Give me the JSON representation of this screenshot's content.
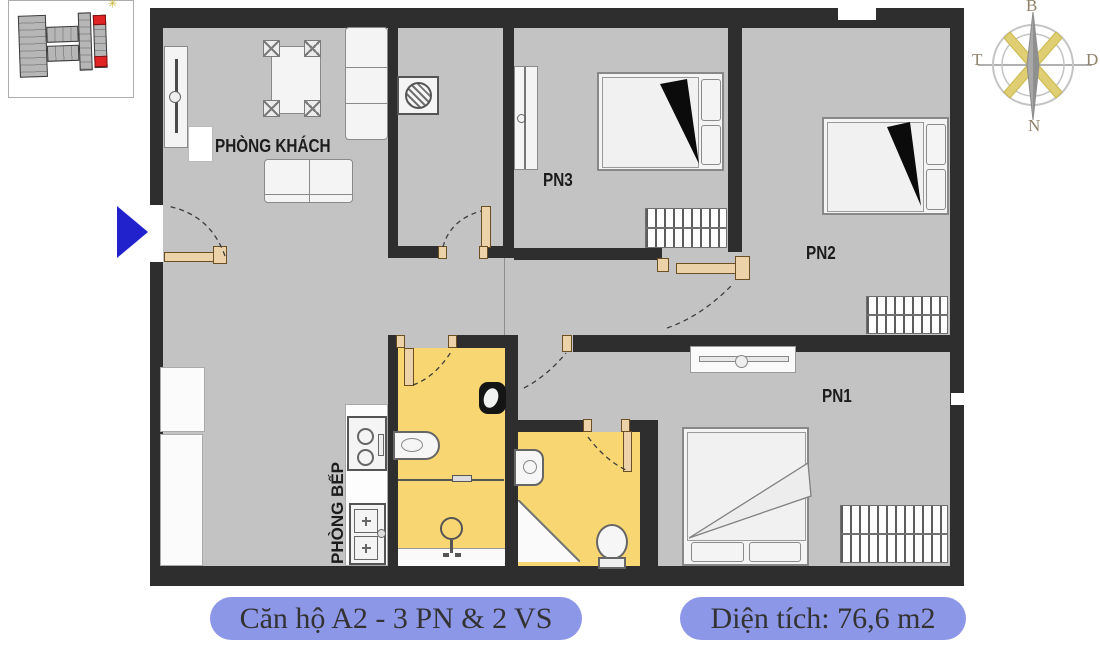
{
  "captions": {
    "apartment_name": "Căn hộ A2 - 3 PN & 2 VS",
    "area": "Diện tích: 76,6 m2"
  },
  "floorplan": {
    "rooms": {
      "living_room": "PHÒNG KHÁCH",
      "kitchen": "PHÒNG BẾP",
      "bedroom_1": "PN1",
      "bedroom_2": "PN2",
      "bedroom_3": "PN3"
    }
  },
  "compass": {
    "north_label": "B",
    "south_label": "N",
    "east_label": "D",
    "west_label": "T"
  },
  "colors": {
    "wall": "#2e2e2e",
    "floor": "#c3c3c3",
    "bathroom_floor": "#f8d672",
    "pill_background": "#8d97e8",
    "entrance_arrow": "#2222cc",
    "door": "#ecd2a8",
    "highlighted_unit": "#e02424"
  },
  "icons": {
    "compass_rose": "compass-rose",
    "entrance_arrow": "right-arrow",
    "washing_machine": "washing-machine",
    "stove": "stove-2-burner",
    "kitchen_sink": "double-sink",
    "toilet": "toilet",
    "shower": "shower",
    "bathroom_sink": "sink",
    "key_plan": "building-key-plan"
  }
}
